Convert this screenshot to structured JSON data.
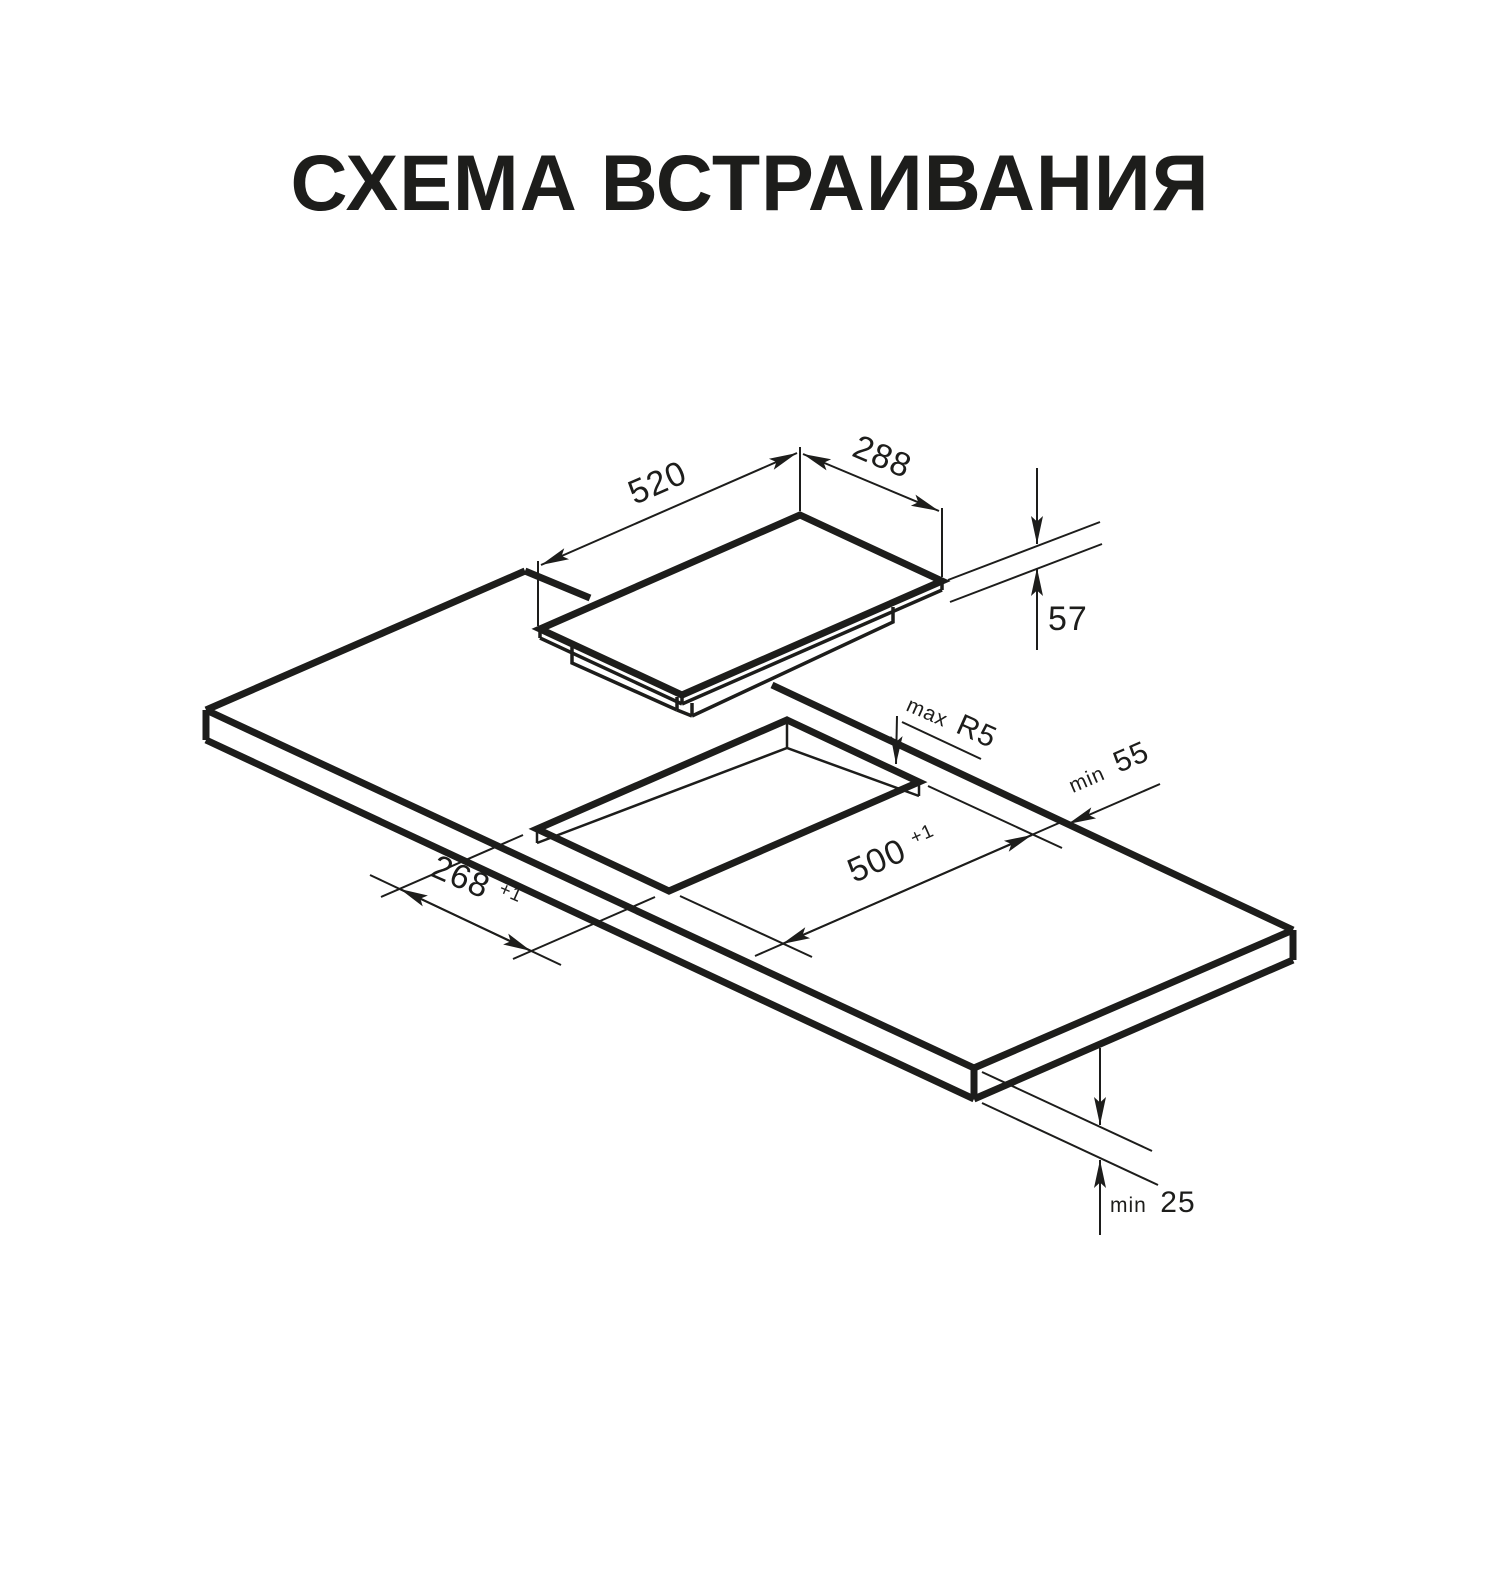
{
  "title": "СХЕМА ВСТРАИВАНИЯ",
  "colors": {
    "line": "#1d1d1b",
    "background": "#ffffff"
  },
  "dimensions": {
    "hob_width": {
      "value": "520"
    },
    "hob_depth": {
      "value": "288"
    },
    "hob_height": {
      "value": "57"
    },
    "corner_radius": {
      "prefix": "max",
      "value": "R5"
    },
    "back_clearance": {
      "prefix": "min",
      "value": "55"
    },
    "cutout_length": {
      "value": "500",
      "tolerance": "+1"
    },
    "cutout_width": {
      "value": "268",
      "tolerance": "+1"
    },
    "worktop_thickness": {
      "prefix": "min",
      "value": "25"
    }
  }
}
